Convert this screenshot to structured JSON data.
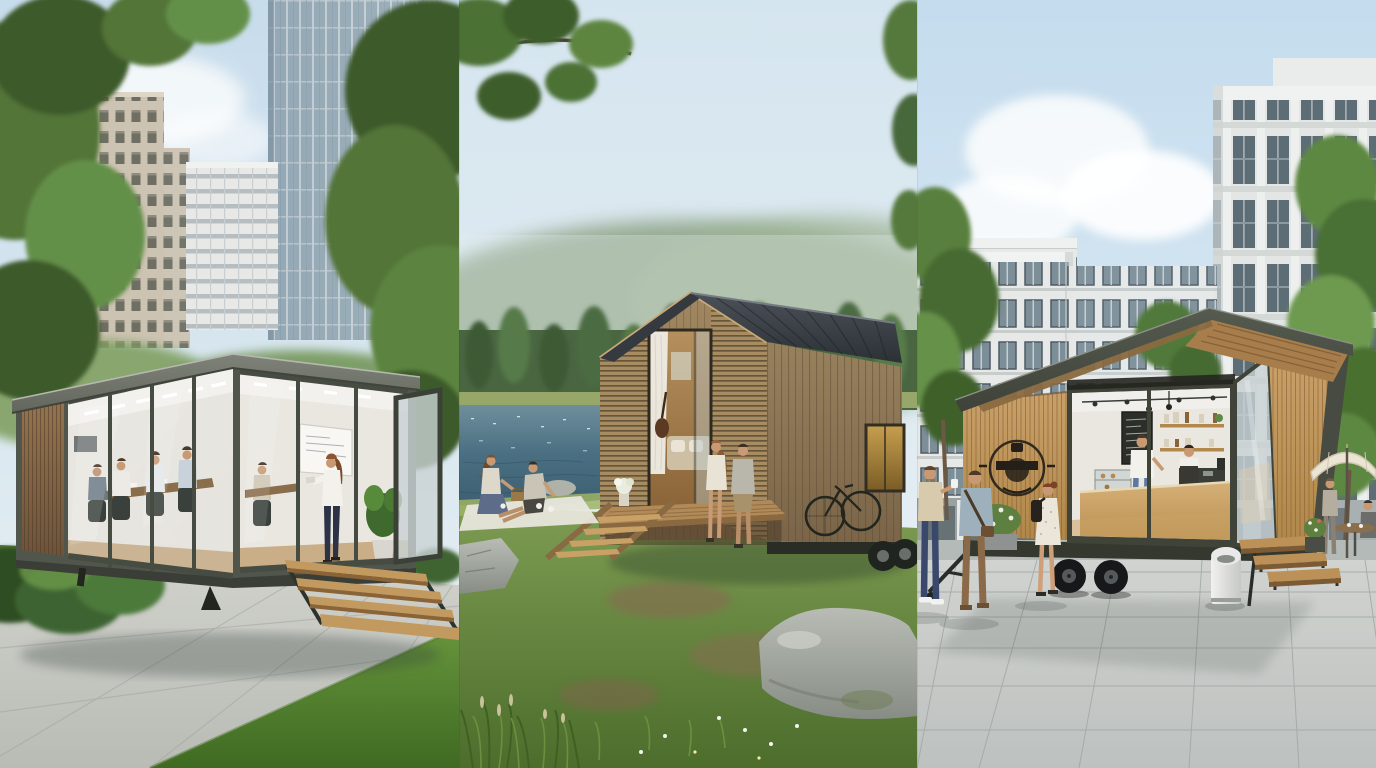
{
  "collage": {
    "kind": "photorealistic architectural rendering triptych",
    "panel_count": 3,
    "visible_text": "none"
  },
  "panels": [
    {
      "id": "office-pod",
      "label": "Glass-walled prefab office pod in an urban park",
      "setting": "city park lawn and concrete path, skyscrapers behind leafy trees",
      "structure": "dark-framed glass meeting pod with wood-slat end wall, gray fascia roof and floating wooden steps",
      "people": [
        "coworkers seated around a long meeting table",
        "woman in white blouse presenting at a whiteboard"
      ],
      "objects": [
        "beige stone high-rise",
        "white apartment block",
        "blue glass tower",
        "park trees",
        "boxwood shrubs",
        "open pivot glass door",
        "potted plant",
        "office chairs",
        "laptops",
        "wall screen"
      ]
    },
    {
      "id": "lakeside-cabin",
      "label": "Wooden tiny cabin on a forest lake shore",
      "setting": "calm lake with sun sparkle, hazy wooded hills, wildflower meadow",
      "structure": "gabled tiny house on trailer wheels with weathered planks, louvered slat wings, dark standing-seam metal roof, timber deck and ladder steps",
      "people": [
        "couple seated on the deck edge",
        "two friends picnicking on a white blanket"
      ],
      "objects": [
        "bicycle leaning on the wall",
        "golden side window",
        "white curtain",
        "sofa with cushions",
        "bouquet on the deck",
        "granite boulders",
        "overhanging branch",
        "picnic basket"
      ]
    },
    {
      "id": "coffee-kiosk",
      "label": "Mobile coffee kiosk trailer on a modern plaza",
      "setting": "white residential blocks, street trees, stone paver plaza",
      "structure": "angular-roof coffee trailer with wood-slat side, round badge logo, open glass corner, double-axle wheels, hitch and timber steps",
      "people": [
        "barista in a dark apron",
        "customer in white tee and blue jeans",
        "two men chatting with coffee",
        "woman in white dress with black backpack",
        "guests under the cafe umbrella"
      ],
      "objects": [
        "chalkboard menu",
        "wooden shelves with jars",
        "espresso machine",
        "pastry case",
        "pendant lamps",
        "white dome litter bin",
        "cream patio umbrella",
        "round cafe table",
        "flower planter"
      ]
    }
  ],
  "palette": {
    "sky-blue": "#c7dcec",
    "sky-pale": "#eaf1f5",
    "cloud-white": "#f7fafb",
    "tower-glass": "#93a8b5",
    "facade-beige": "#cdc3b2",
    "facade-white": "#e8e9e7",
    "window-dark": "#5d6d76",
    "tree-dark": "#3c5a2a",
    "tree-mid": "#527538",
    "tree-light": "#6b9749",
    "pod-frame": "#51564c",
    "fascia-gray": "#7e8278",
    "glass-tint": "#c3ced1",
    "interior-white": "#eae7e1",
    "wood-dark": "#8a6e4e",
    "wood-light": "#c29a5f",
    "pavement": "#c9cbc5",
    "lawn-green": "#55803a",
    "haze-hill": "#8ba283",
    "forest-green": "#496641",
    "lake-deep": "#3a5d6e",
    "lake-mid": "#4a6f82",
    "lake-light": "#6f8e9c",
    "meadow-light": "#7e9c52",
    "meadow-dark": "#4c6d2c",
    "cabin-wood": "#97815d",
    "roof-charcoal": "#2c3136",
    "porch-wood": "#b28a58",
    "glow-warm": "#b5905e",
    "rock-gray": "#a9ada6",
    "kiosk-frame": "#3f4338",
    "kiosk-wood": "#c9a069",
    "counter-wood": "#d6b077",
    "chalkboard": "#2c2e29",
    "denim": "#5b79a2",
    "plaza-light": "#d0d3d0",
    "plaza-dark": "#bdc1bf",
    "umbrella-cream": "#ece5d3",
    "bin-white": "#f1f1ef",
    "skin": "#c99973"
  }
}
